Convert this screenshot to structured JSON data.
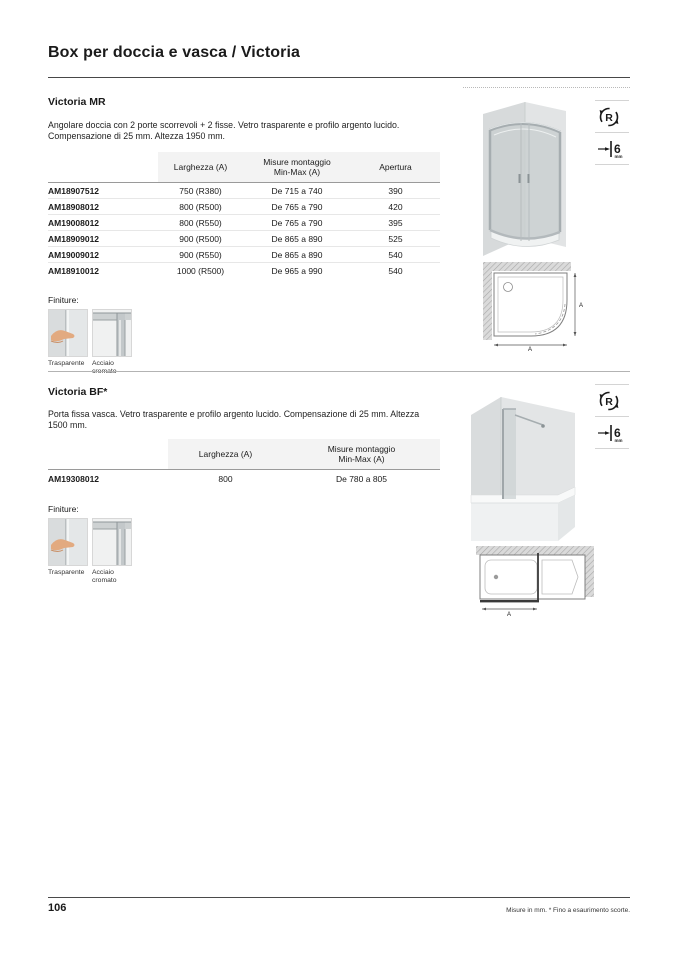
{
  "page": {
    "title": "Box per doccia e vasca / Victoria",
    "page_number": "106",
    "footer_note": "Misure in mm. * Fino a esaurimento scorte."
  },
  "badges": {
    "reversible": "R",
    "thickness_value": "6",
    "thickness_unit": "mm"
  },
  "finishes": {
    "label": "Finiture:",
    "items": [
      {
        "name": "Trasparente"
      },
      {
        "name": "Acciaio cromato"
      }
    ]
  },
  "sections": [
    {
      "heading": "Victoria MR",
      "description_line1": "Angolare doccia con 2 porte scorrevoli + 2 fisse. Vetro trasparente e profilo argento lucido.",
      "description_line2": "Compensazione di 25 mm. Altezza 1950 mm.",
      "table": {
        "headers": [
          "Larghezza (A)",
          "Misure montaggio\nMin-Max (A)",
          "Apertura"
        ],
        "rows": [
          [
            "AM18907512",
            "750 (R380)",
            "De 715 a 740",
            "390"
          ],
          [
            "AM18908012",
            "800 (R500)",
            "De 765 a 790",
            "420"
          ],
          [
            "AM19008012",
            "800 (R550)",
            "De 765 a 790",
            "395"
          ],
          [
            "AM18909012",
            "900 (R500)",
            "De 865 a 890",
            "525"
          ],
          [
            "AM19009012",
            "900 (R550)",
            "De 865 a 890",
            "540"
          ],
          [
            "AM18910012",
            "1000 (R500)",
            "De 965 a 990",
            "540"
          ]
        ]
      },
      "schematic": {
        "width_label": "A",
        "height_label": "A"
      }
    },
    {
      "heading": "Victoria BF*",
      "description_line1": "Porta fissa vasca. Vetro trasparente e profilo argento lucido. Compensazione di 25 mm. Altezza 1500 mm.",
      "table": {
        "headers": [
          "Larghezza (A)",
          "Misure montaggio\nMin-Max (A)"
        ],
        "rows": [
          [
            "AM19308012",
            "800",
            "De 780 a 805"
          ]
        ]
      },
      "schematic": {
        "width_label": "A"
      }
    }
  ]
}
